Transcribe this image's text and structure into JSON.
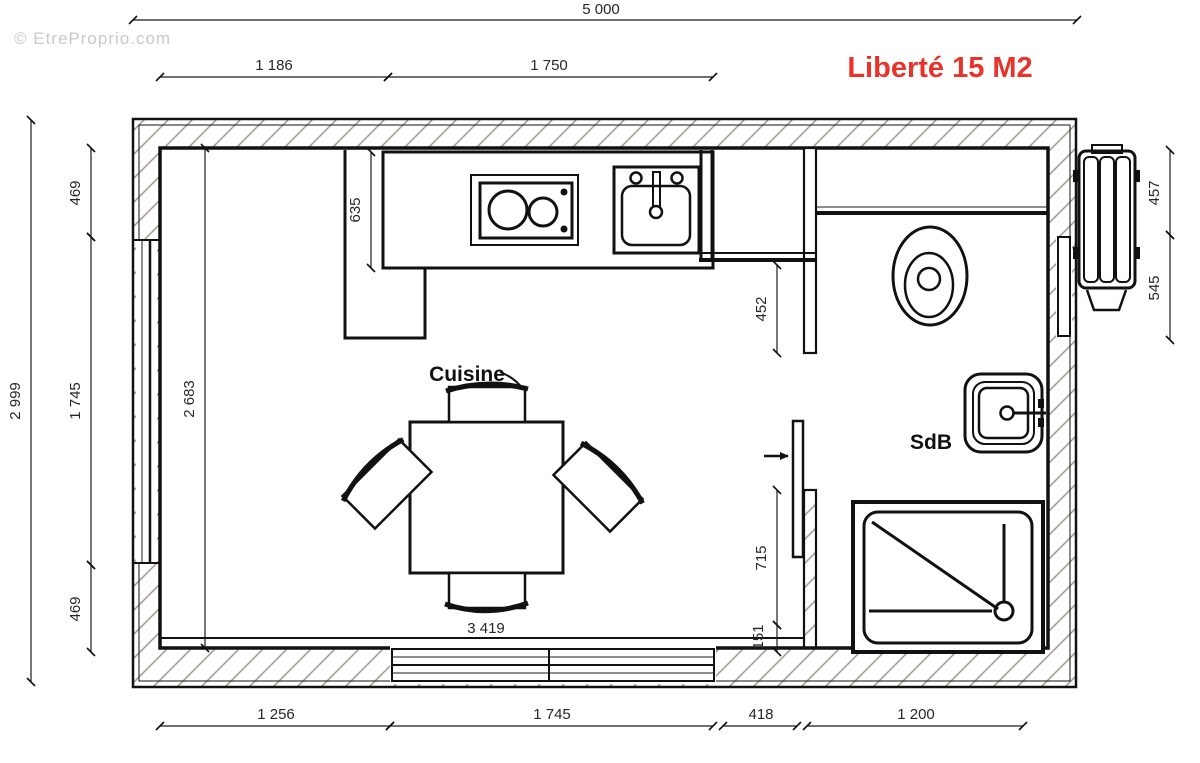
{
  "title": "Liberté 15 M2",
  "watermark": "© EtreProprio.com",
  "rooms": {
    "kitchen_label": "Cuisine",
    "bathroom_label": "SdB"
  },
  "dims": {
    "total_width": "5 000",
    "top_left_segment": "1 186",
    "counter_width": "1 750",
    "total_height": "2 999",
    "left_top": "469",
    "left_window": "1 745",
    "left_bottom": "469",
    "counter_depth": "635",
    "interior_height": "2 683",
    "bath_upper": "452",
    "bath_door": "715",
    "bath_lower": "151",
    "heater_top": "457",
    "heater_bottom": "545",
    "bottom_wall_left": "1 256",
    "bottom_window": "1 745",
    "bottom_door": "418",
    "bottom_bath": "1 200",
    "table_zone": "3 419"
  },
  "colors": {
    "title_red": "#e8332a",
    "line_black": "#111111",
    "hatch_gray": "#a89d96",
    "watermark_gray": "#c9c9c9"
  }
}
